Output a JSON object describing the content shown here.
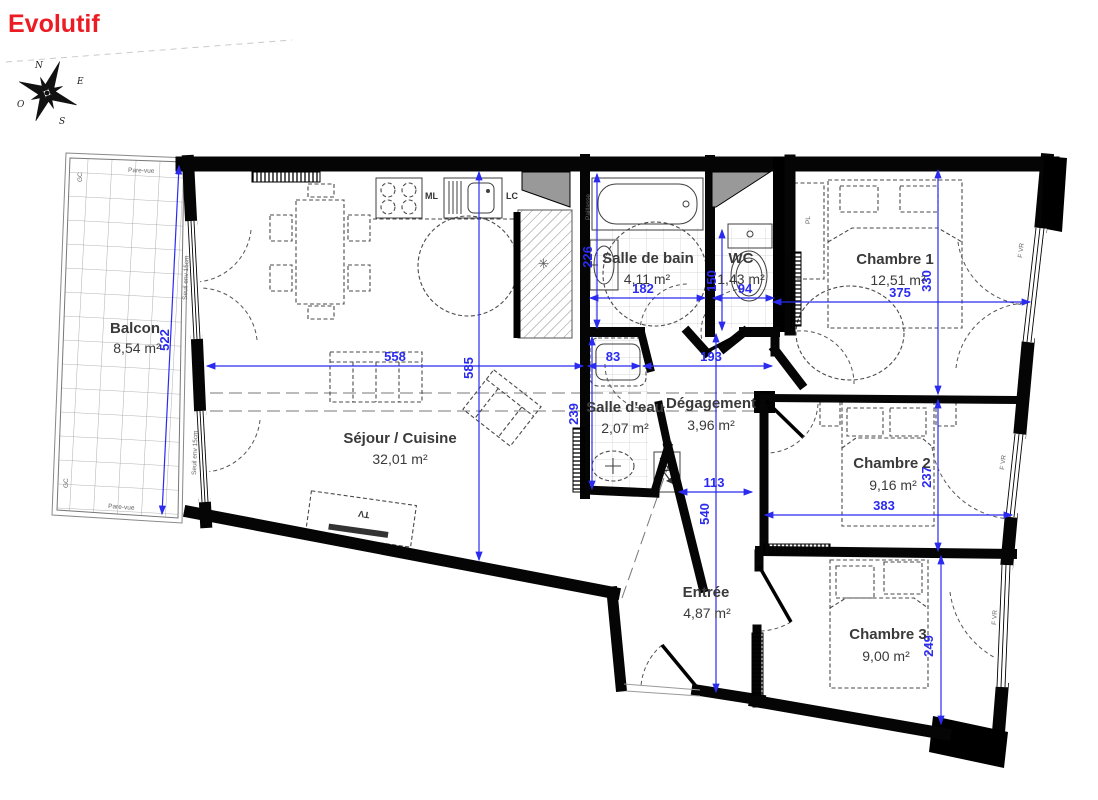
{
  "title": {
    "text": "Evolutif",
    "color": "#ec1c24"
  },
  "compass": {
    "north": "N",
    "east": "E",
    "south": "S",
    "west": "O"
  },
  "rooms": [
    {
      "name": "Balcon",
      "area": "8,54 m²"
    },
    {
      "name": "Séjour / Cuisine",
      "area": "32,01 m²"
    },
    {
      "name": "Salle de bain",
      "area": "4,11 m²"
    },
    {
      "name": "WC",
      "area": "1,43 m²"
    },
    {
      "name": "Chambre 1",
      "area": "12,51 m²"
    },
    {
      "name": "Salle d'eau",
      "area": "2,07 m²"
    },
    {
      "name": "Dégagement",
      "area": "3,96 m²"
    },
    {
      "name": "Chambre 2",
      "area": "9,16 m²"
    },
    {
      "name": "Entrée",
      "area": "4,87 m²"
    },
    {
      "name": "Chambre 3",
      "area": "9,00 m²"
    }
  ],
  "dimensions_cm": {
    "balcony_height": "522",
    "sejour_width": "558",
    "sejour_height": "585",
    "sdb_depth": "226",
    "sdb_width": "182",
    "wc_width": "94",
    "wc_depth": "150",
    "ch1_width": "375",
    "ch1_depth": "330",
    "sde_width": "83",
    "sde_depth": "239",
    "degagement_width": "193",
    "entree_width": "113",
    "entree_depth": "540",
    "ch2_width": "383",
    "ch2_depth": "237",
    "ch3_depth": "249"
  },
  "annotations": {
    "pare_vue": "Pare-vue",
    "gc": "GC",
    "seuil": "Seuil env 15cm",
    "paillasse": "Paillasse",
    "ml": "ML",
    "lc": "LC",
    "pl": "PL",
    "tv": "TV",
    "fvr": "F VR"
  },
  "colors": {
    "walls": "#000000",
    "dimensions": "#2b2bf0",
    "room_labels": "#3a3a3a",
    "title": "#ec1c24",
    "shaft_fill": "#999999"
  }
}
